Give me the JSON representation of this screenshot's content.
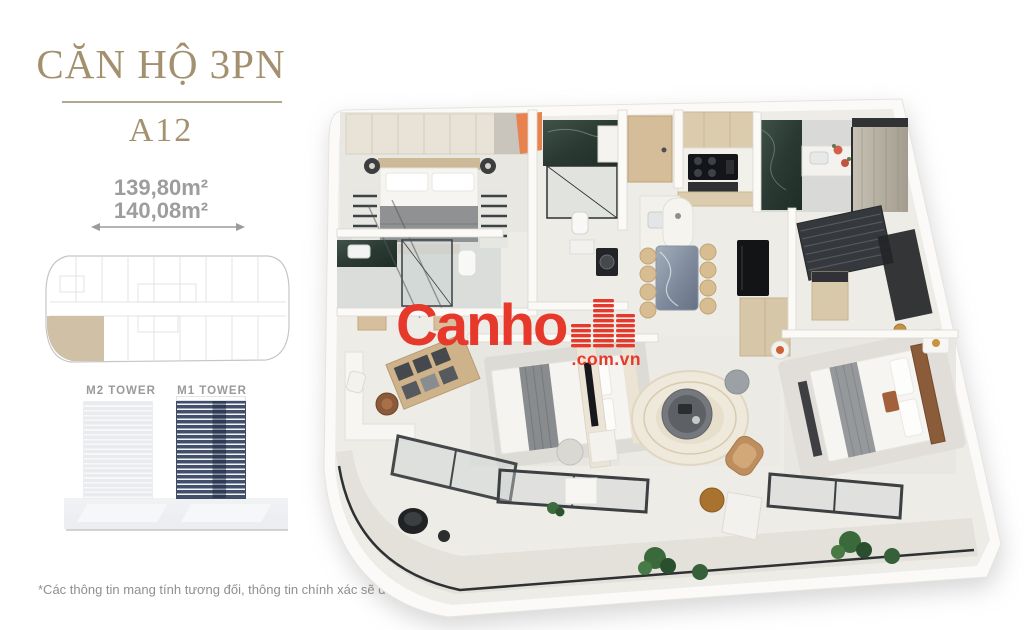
{
  "panel": {
    "title": "CĂN HỘ 3PN",
    "unit_code": "A12",
    "area_line1": "139,80m²",
    "area_line2": "140,08m²",
    "tower_m2_label": "M2 TOWER",
    "tower_m1_label": "M1 TOWER"
  },
  "watermark": {
    "brand": "Canho",
    "suffix": ".com.vn",
    "color": "#e6382b"
  },
  "footer": {
    "disclaimer": "*Các thông tin mang tính tương đối, thông tin chính xác sẽ được thể hiện trong Hợp đồng mua bán."
  },
  "colors": {
    "title_text": "#a3906e",
    "area_text": "#9d9d9d",
    "highlighted_unit": "#cfc0a6",
    "tower_m1_navy": "#42506c",
    "accent_orange": "#e8834f",
    "marble_dark": "#31413a",
    "wood_beige": "#d7c2a0"
  }
}
